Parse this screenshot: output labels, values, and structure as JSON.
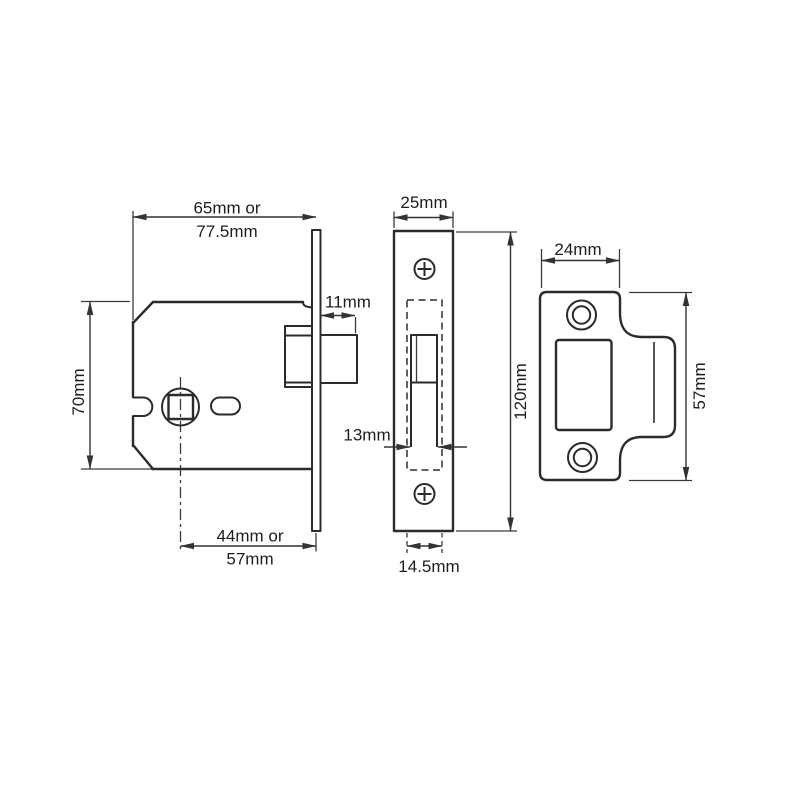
{
  "colors": {
    "background": "#ffffff",
    "object_line": "#2b2b2b",
    "dimension_line": "#333333",
    "text": "#1d1d1d"
  },
  "drawing": {
    "body_view": {
      "depth_line1": "65mm or",
      "depth_line2": "77.5mm",
      "height": "70mm",
      "bolt_projection": "11mm",
      "backset_line1": "44mm or",
      "backset_line2": "57mm"
    },
    "faceplate_view": {
      "width": "25mm",
      "height": "120mm",
      "bolt_width": "13mm",
      "case_width": "14.5mm"
    },
    "strike_view": {
      "width": "24mm",
      "height": "57mm"
    }
  }
}
